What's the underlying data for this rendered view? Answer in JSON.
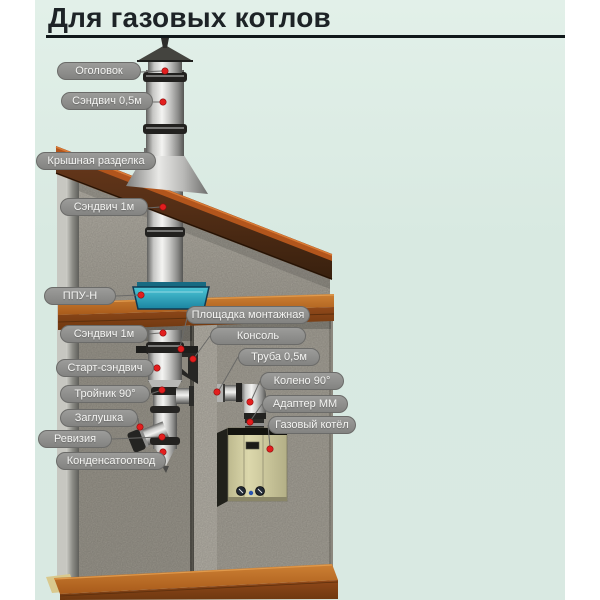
{
  "title": {
    "text": "Для газовых котлов"
  },
  "diagram": {
    "description": "Gas boiler chimney installation scheme",
    "labels": [
      {
        "id": "ogolovok",
        "text": "Оголовок"
      },
      {
        "id": "sandwich-05m",
        "text": "Сэндвич 0,5м"
      },
      {
        "id": "kryshnaya-razdelka",
        "text": "Крышная разделка"
      },
      {
        "id": "sandwich-1m-upper",
        "text": "Сэндвич 1м"
      },
      {
        "id": "ppu-n",
        "text": "ППУ-Н"
      },
      {
        "id": "ploshchadka-montazhnaya",
        "text": "Площадка монтажная"
      },
      {
        "id": "sandwich-1m-lower",
        "text": "Сэндвич 1м"
      },
      {
        "id": "konsol",
        "text": "Консоль"
      },
      {
        "id": "start-sandwich",
        "text": "Старт-сэндвич"
      },
      {
        "id": "truba-05m",
        "text": "Труба 0,5м"
      },
      {
        "id": "troynik-90",
        "text": "Тройник 90°"
      },
      {
        "id": "koleno-90",
        "text": "Колено 90°"
      },
      {
        "id": "zaglushka",
        "text": "Заглушка"
      },
      {
        "id": "adapter-mm",
        "text": "Адаптер ММ"
      },
      {
        "id": "reviziya",
        "text": "Ревизия"
      },
      {
        "id": "gazovyy-kotel",
        "text": "Газовый котёл"
      },
      {
        "id": "kondensatootvod",
        "text": "Конденсатоотвод"
      }
    ],
    "colors": {
      "background_mint": "#d9e9e2",
      "badge_gray": "#8f8f8d",
      "marker_red": "#e31e1e",
      "ppu_teal": "#2fb0c4",
      "wood_orange": "#b4661e",
      "roof_brown": "#53301a",
      "pipe_metal": "#c8c8c6"
    }
  }
}
